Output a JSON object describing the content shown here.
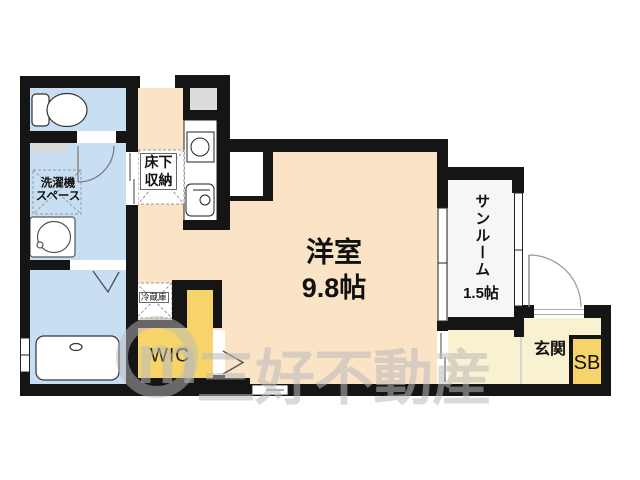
{
  "plan": {
    "type": "floor-plan",
    "rooms": {
      "main_room": {
        "name": "洋室",
        "size": "9.8帖"
      },
      "sunroom": {
        "name": "サンルーム",
        "size": "1.5帖"
      },
      "entrance": {
        "name": "玄関"
      },
      "shoe_box": {
        "name": "SB"
      },
      "walk_in_closet": {
        "name": "WIC"
      },
      "refrigerator": {
        "name": "冷蔵庫"
      },
      "underfloor_storage": {
        "line1": "床下",
        "line2": "収納"
      },
      "washer_space": {
        "line1": "洗濯機",
        "line2": "スペース"
      }
    },
    "watermark": {
      "logo_letter": "m",
      "company": "三好不動産"
    },
    "colors": {
      "wall": "#151515",
      "main_room_floor": "#fbe3c6",
      "wet_area_floor": "#c8def2",
      "closet_floor": "#f7d469",
      "entrance_floor": "#f8f2d0",
      "sunroom_floor": "#f6f6f4",
      "pipe_space": "#dcdcdc",
      "watermark": "#bababa"
    }
  }
}
